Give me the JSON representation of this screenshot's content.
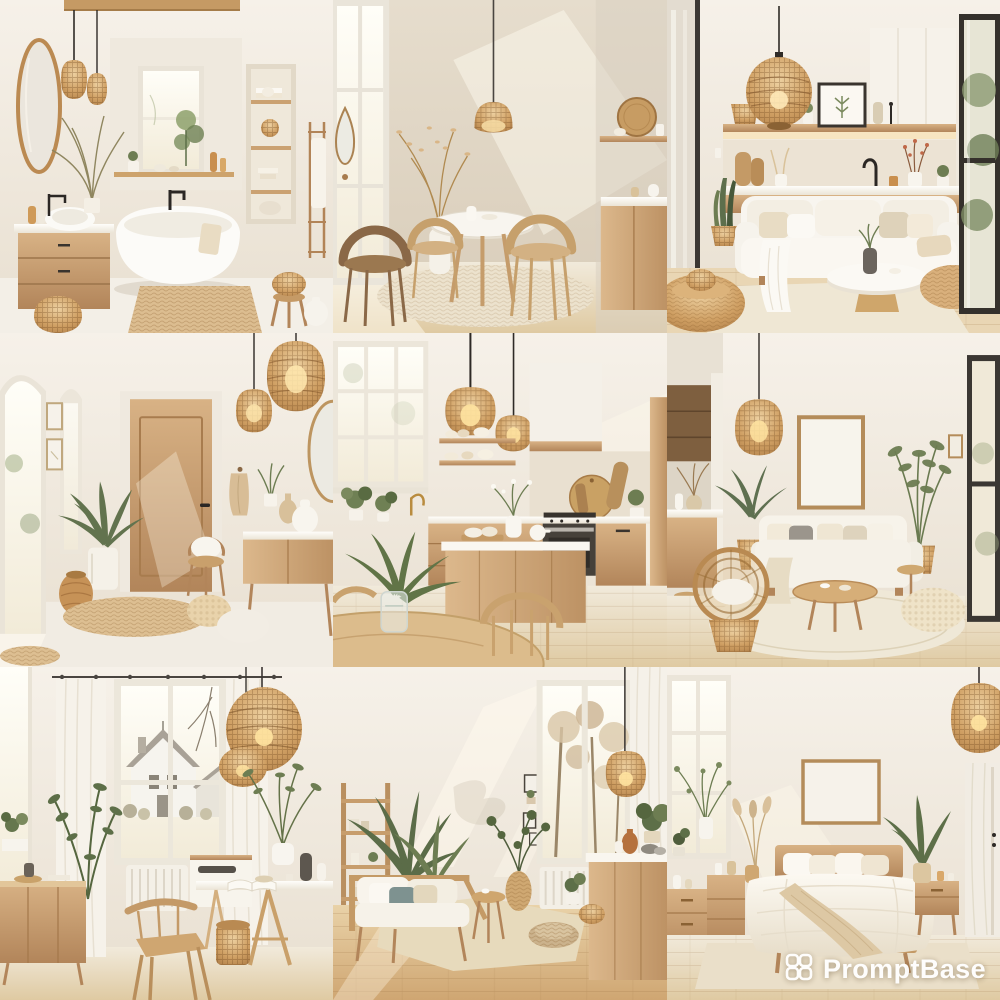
{
  "watermark": {
    "text": "PromptBase",
    "logo_icon": "promptbase-knot-icon",
    "text_color": "#ffffff"
  },
  "grid": {
    "rows": 3,
    "columns": 3,
    "cells": [
      {
        "id": "bathroom",
        "label": "Bathroom with freestanding tub, round mirror, rattan pendants and oak vanity"
      },
      {
        "id": "dining-nook",
        "label": "Sunlit dining nook with round white table and rattan barrel chairs"
      },
      {
        "id": "living-sofa",
        "label": "Living room with white sofa, rattan globe pendant and long open shelf"
      },
      {
        "id": "entryway",
        "label": "Entryway with wooden door, rattan pendant lights and palm plant"
      },
      {
        "id": "kitchen",
        "label": "Kitchen with rattan pendants, oak cabinets and dining table in front"
      },
      {
        "id": "living-frame",
        "label": "Living room with blank poster frame, beige sofa and rattan armchair"
      },
      {
        "id": "office-dining",
        "label": "Dining workspace by a window with a house view and wicker pendants"
      },
      {
        "id": "living-daybed",
        "label": "Living space with wooden daybed, plant shelves and kitchen island"
      },
      {
        "id": "bedroom",
        "label": "Bedroom with oak bed, layered beige bedding and rattan pendant"
      }
    ]
  },
  "palette": {
    "wall": "#efe8dc",
    "wood": "#c79e6b",
    "rattan": "#c99a5f",
    "floor": "#e3cda6",
    "linen": "#f6f2e9",
    "greenery": "#65754c",
    "fixture_black": "#2e2a26"
  }
}
